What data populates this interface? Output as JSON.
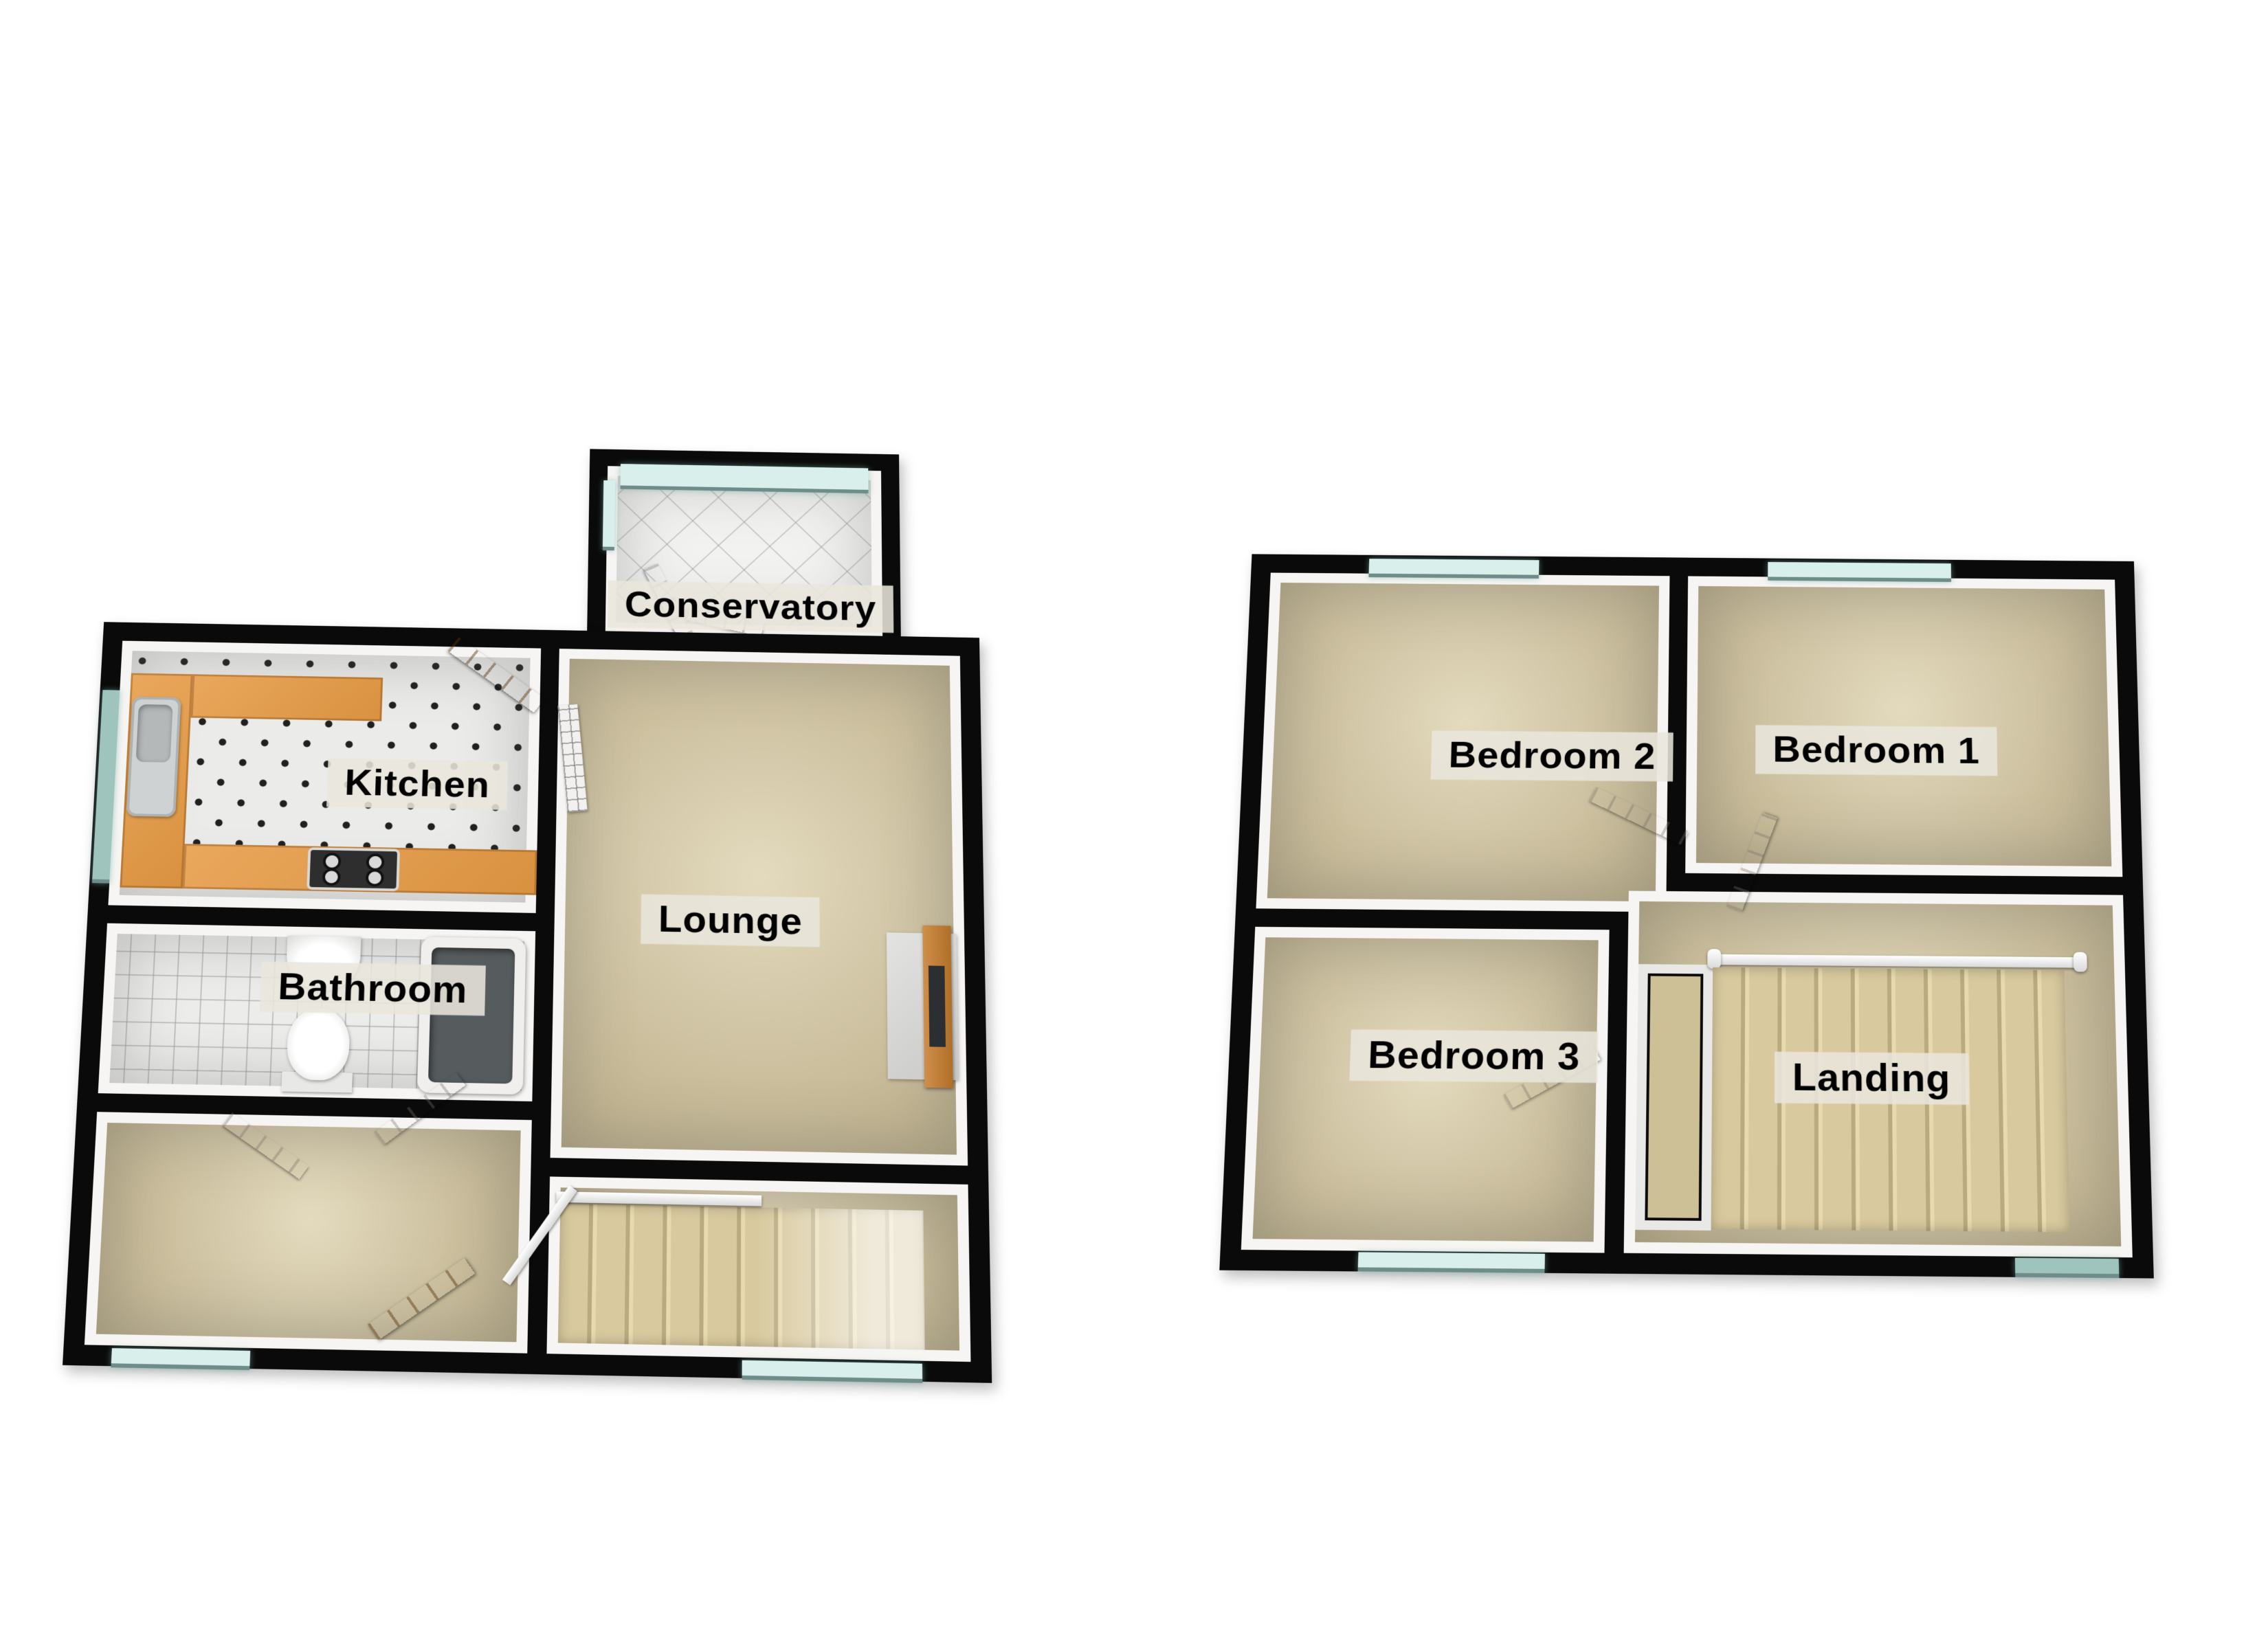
{
  "floors": [
    {
      "id": "ground-floor",
      "rooms": [
        {
          "key": "conservatory",
          "label": "Conservatory"
        },
        {
          "key": "kitchen",
          "label": "Kitchen"
        },
        {
          "key": "bathroom",
          "label": "Bathroom"
        },
        {
          "key": "lounge",
          "label": "Lounge"
        }
      ],
      "fixtures": [
        "kitchen-sink",
        "gas-hob",
        "kitchen-counter",
        "wash-basin",
        "toilet",
        "bathtub",
        "radiator",
        "fireplace",
        "staircase",
        "front-door",
        "back-door",
        "windows"
      ]
    },
    {
      "id": "first-floor",
      "rooms": [
        {
          "key": "bedroom2",
          "label": "Bedroom 2"
        },
        {
          "key": "bedroom1",
          "label": "Bedroom 1"
        },
        {
          "key": "bedroom3",
          "label": "Bedroom 3"
        },
        {
          "key": "landing",
          "label": "Landing"
        }
      ],
      "fixtures": [
        "staircase",
        "banister",
        "stairwell",
        "windows",
        "doors"
      ]
    }
  ],
  "colors": {
    "wall": "#0a0a0a",
    "carpet": "#d5c69d",
    "tile": "#ededec",
    "counter_wood": "#e09a4b",
    "door_wood": "#c08140",
    "glass": "#d9efec",
    "label_bg": "#e9e6dd",
    "label_text": "#000000"
  }
}
